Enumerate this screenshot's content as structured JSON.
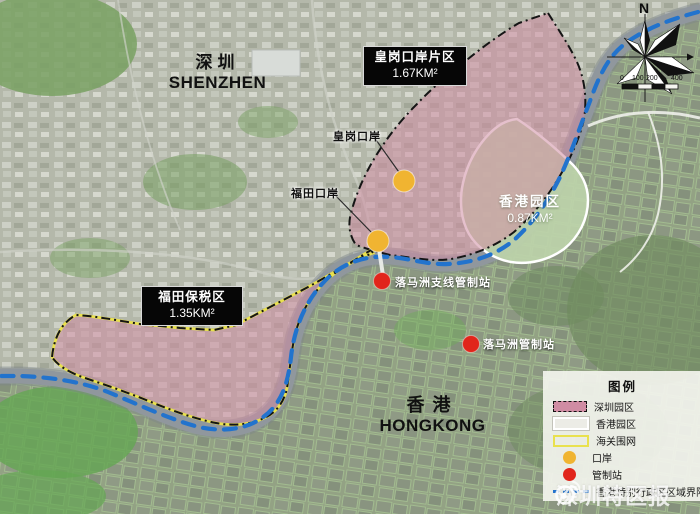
{
  "colors": {
    "shenzhen_zone": "#d08ca3",
    "hk_zone": "#bed4ab",
    "customs_fence": "#e9e14e",
    "port": "#f0b431",
    "checkpoint": "#e1251b",
    "boundary": "#2273cd",
    "river": "#90979d",
    "urban": "#b4b8aa",
    "farmland": "#8ea17d"
  },
  "map": {
    "cities": [
      {
        "cn": "深圳",
        "en": "SHENZHEN"
      },
      {
        "cn": "香港",
        "en": "HONGKONG"
      }
    ],
    "zones": [
      {
        "name": "皇岗口岸片区",
        "area": "1.67KM²"
      },
      {
        "name": "福田保税区",
        "area": "1.35KM²"
      },
      {
        "name": "香港园区",
        "area": "0.87KM²"
      }
    ],
    "port_labels": [
      "皇岗口岸",
      "福田口岸"
    ],
    "checkpoint_labels": [
      "落马洲支线管制站",
      "落马洲管制站"
    ],
    "compass_north": "N",
    "scale_ticks": [
      "0",
      "100",
      "200",
      "400"
    ]
  },
  "legend": {
    "title": "图例",
    "items": [
      {
        "label": "深圳园区",
        "swatch": "shenzhen-zone"
      },
      {
        "label": "香港园区",
        "swatch": "hongkong-zone"
      },
      {
        "label": "海关围网",
        "swatch": "customs-fence"
      },
      {
        "label": "口岸",
        "swatch": "port-dot"
      },
      {
        "label": "管制站",
        "swatch": "checkpoint-dot"
      },
      {
        "label": "香港特别行政区区域界限",
        "swatch": "boundary-line"
      }
    ]
  },
  "watermark": {
    "text": "深圳特区报"
  }
}
